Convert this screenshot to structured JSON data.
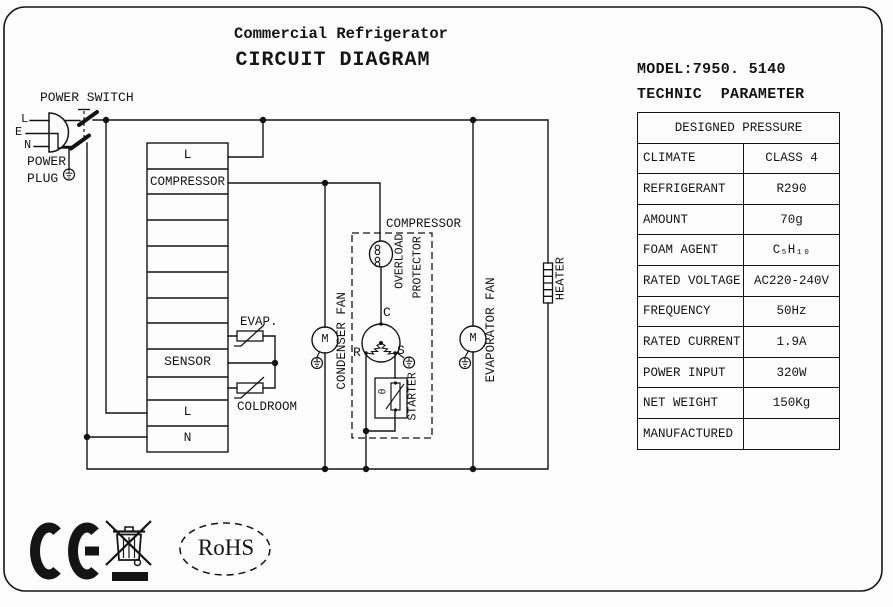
{
  "title": {
    "product": "Commercial Refrigerator",
    "heading": "CIRCUIT DIAGRAM"
  },
  "power": {
    "switch_label": "POWER SWITCH",
    "plug_label": [
      "POWER",
      "PLUG"
    ],
    "pins": [
      "L",
      "E",
      "N"
    ]
  },
  "terminal_block": {
    "rows": [
      "L",
      "COMPRESSOR",
      "",
      "",
      "",
      "",
      "",
      "",
      "SENSOR",
      "",
      "L",
      "N"
    ]
  },
  "sensors": {
    "evap_label": "EVAP.",
    "coldroom_label": "COLDROOM"
  },
  "components": {
    "condenser_fan": "CONDENSER FAN",
    "evaporator_fan": "EVAPORATOR FAN",
    "heater": "HEATER",
    "compressor": "COMPRESSOR",
    "overload": [
      "OVERLOAD",
      "PROTECTOR"
    ],
    "starter": "STARTER",
    "theta": "θ",
    "motor": "M",
    "terminals": {
      "c": "C",
      "r": "R",
      "s": "S"
    }
  },
  "spec": {
    "model": "MODEL:7950. 5140",
    "heading": "TECHNIC  PARAMETER",
    "table": {
      "header": "DESIGNED PRESSURE",
      "rows": [
        [
          "CLIMATE",
          "CLASS 4"
        ],
        [
          "REFRIGERANT",
          "R290"
        ],
        [
          "AMOUNT",
          "70g"
        ],
        [
          "FOAM AGENT",
          "C₅H₁₀"
        ],
        [
          "RATED VOLTAGE",
          "AC220-240V"
        ],
        [
          "FREQUENCY",
          "50Hz"
        ],
        [
          "RATED CURRENT",
          "1.9A"
        ],
        [
          "POWER INPUT",
          "320W"
        ],
        [
          "NET WEIGHT",
          "150Kg"
        ],
        [
          "MANUFACTURED",
          ""
        ]
      ]
    }
  },
  "certifications": {
    "rohs": "RoHS"
  }
}
